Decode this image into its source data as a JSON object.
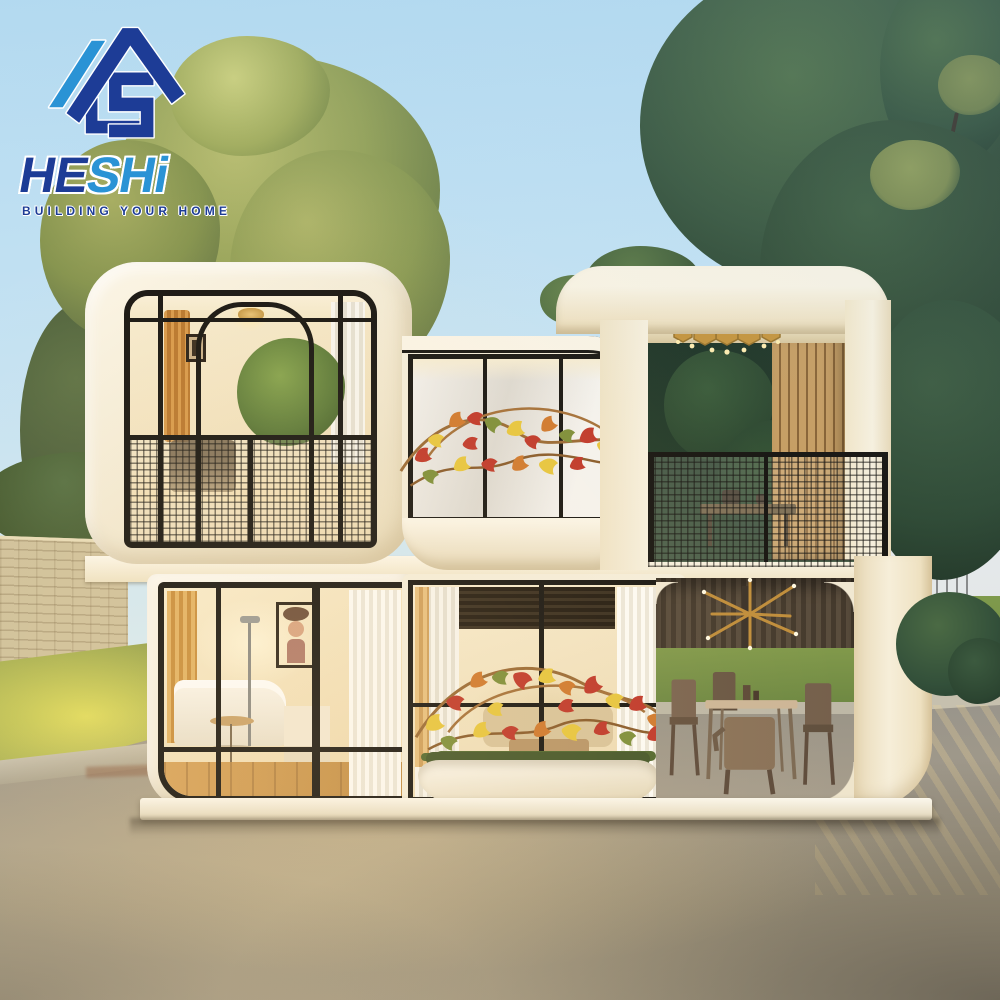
{
  "logo": {
    "mark": "house-hs-monogram",
    "brand_dark": "HE",
    "brand_light": "SHi",
    "tagline": "BUILDING YOUR HOME",
    "colors": {
      "navy": "#1d3c96",
      "blue": "#2a93d5",
      "outline": "#ffffff"
    }
  },
  "scene": {
    "subject": "two-storey modular capsule house render",
    "palette": {
      "sky": "#c3e0f1",
      "capsule_white": "#f5eedd",
      "frame_black": "#191713",
      "tree_olive": "#7f9052",
      "tree_dark": "#2f4a35",
      "lawn": "#93a24c",
      "brick_wall": "#cfc19c",
      "asphalt": "#9a968c",
      "gold": "#c6953e",
      "autumn_red": "#c0392b",
      "autumn_yellow": "#e7c63f"
    },
    "objects": [
      "upper-left-cabin-with-balcony",
      "upper-middle-cabin-with-vine",
      "rooftop-terrace",
      "gold-honeycomb-chandelier",
      "mesh-balcony-railing",
      "lower-bedroom-cabin",
      "portrait-artwork",
      "oval-planter-with-vine",
      "patio-dining-set",
      "gold-starburst-ornament",
      "brick-wall",
      "hedge",
      "lawn",
      "olive-tree",
      "dark-green-trees",
      "background-house",
      "asphalt-pavement"
    ]
  }
}
